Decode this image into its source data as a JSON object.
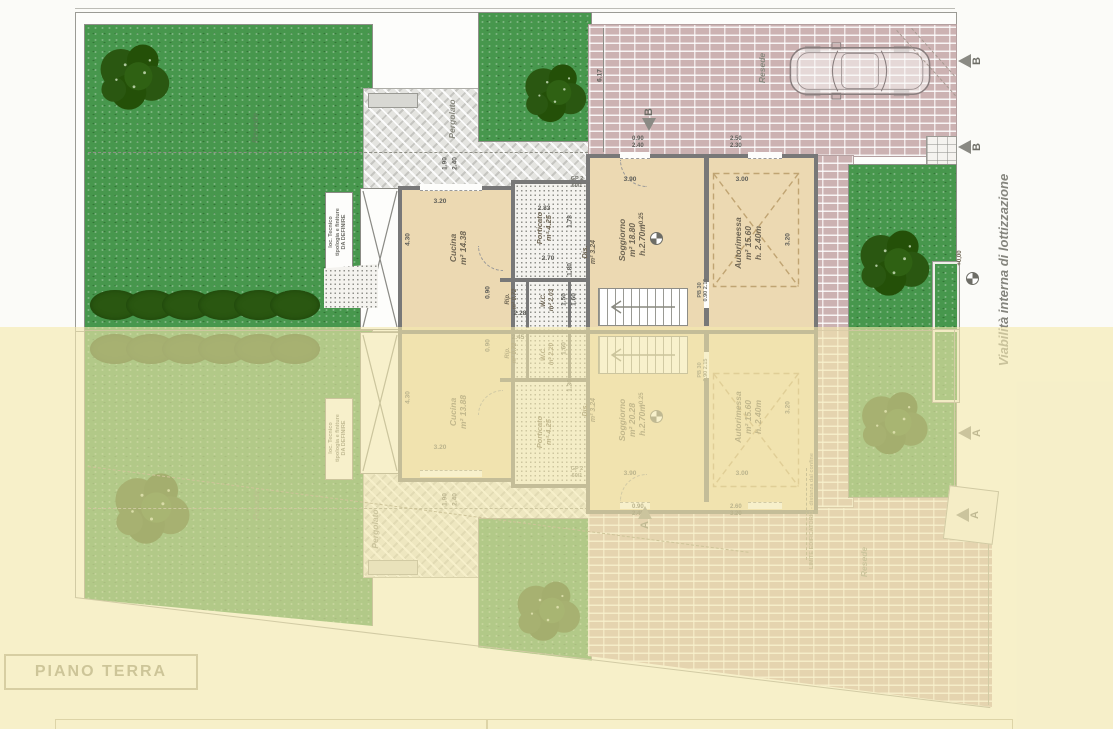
{
  "title_block": {
    "label": "PIANO TERRA"
  },
  "legend": {
    "viability": "Viabilità interna di lottizzazione",
    "limite": "LIMITE EDIFICATORIO - distanza dal confine",
    "resede_drive": "Resede",
    "resede_lawn": "Resede",
    "resede_bottom": "Resede",
    "resede_lawn_bottom": "Resede",
    "pergolato_top": "Pergolato",
    "pergolato_bottom": "Pergolato",
    "section_b": "B",
    "section_a": "A",
    "level_plus025": "+0.25",
    "level_zero": "+0,00",
    "loc_line1": "loc. Tecnico",
    "loc_line2": "tipologia e finiture",
    "loc_line3": "DA DEFINIRE",
    "gp_door": "GP 2",
    "gp_size": "60/1",
    "pb_door": "PB 30",
    "pb_size": "0.90 2.15"
  },
  "plan_top": {
    "rooms": {
      "cucina": {
        "name": "Cucina",
        "area": "m² 14.38"
      },
      "porticato": {
        "name": "Porticato",
        "area": "m² 4.25"
      },
      "dis": {
        "name": "Dis.",
        "area": "m² 3.24"
      },
      "wc": {
        "name": "W.C.",
        "area": "m² 2.03"
      },
      "rip": {
        "name": "Rip.",
        "area": "m² 0.72"
      },
      "soggiorno": {
        "name": "Soggiorno",
        "area": "m² 18.80",
        "height": "h.2.70m"
      },
      "autorimessa": {
        "name": "Autorimessa",
        "area": "m² 15.60",
        "height": "h. 2.40m"
      }
    },
    "dims": [
      "6.17",
      "3.20",
      "4.30",
      "1.90",
      "2.40",
      "2.83",
      "1.78",
      "2.70",
      "1.80",
      "3.90",
      "3.00",
      "3.20",
      "0.90",
      "2.28",
      "1.50",
      "1.60",
      "0.90",
      "2.40",
      "2.50",
      "2.30"
    ]
  },
  "plan_bottom": {
    "rooms": {
      "cucina": {
        "name": "Cucina",
        "area": "m² 13.88"
      },
      "porticato": {
        "name": "Porticato",
        "area": "m² 4.25"
      },
      "dis": {
        "name": "Dis.",
        "area": "m² 3.24"
      },
      "wc": {
        "name": "W.C.",
        "area": "m² 2.20"
      },
      "rip": {
        "name": "Rip.",
        "area": "m² 0.72"
      },
      "soggiorno": {
        "name": "Soggiorno",
        "area": "m² 20.28",
        "height": "h.2.70m"
      },
      "autorimessa": {
        "name": "Autorimessa",
        "area": "m² 15.60",
        "height": "h. 2.40m"
      }
    },
    "dims": [
      "3.20",
      "4.30",
      "2.45",
      "0.90",
      "1.60",
      "1.30",
      "3.90",
      "3.00",
      "3.20",
      "0.90",
      "2.40",
      "2.60",
      "3.20",
      "1.90",
      "2.40"
    ]
  },
  "colors": {
    "lawn": "#47974d",
    "tree": "#2a5711",
    "brick": "#ccb2b2",
    "paving": "#e4e4e0",
    "interior": "#ecd9b2",
    "wall": "#787878",
    "overlay_yellow": "#f3e8ac",
    "label_text": "#6f6654"
  }
}
